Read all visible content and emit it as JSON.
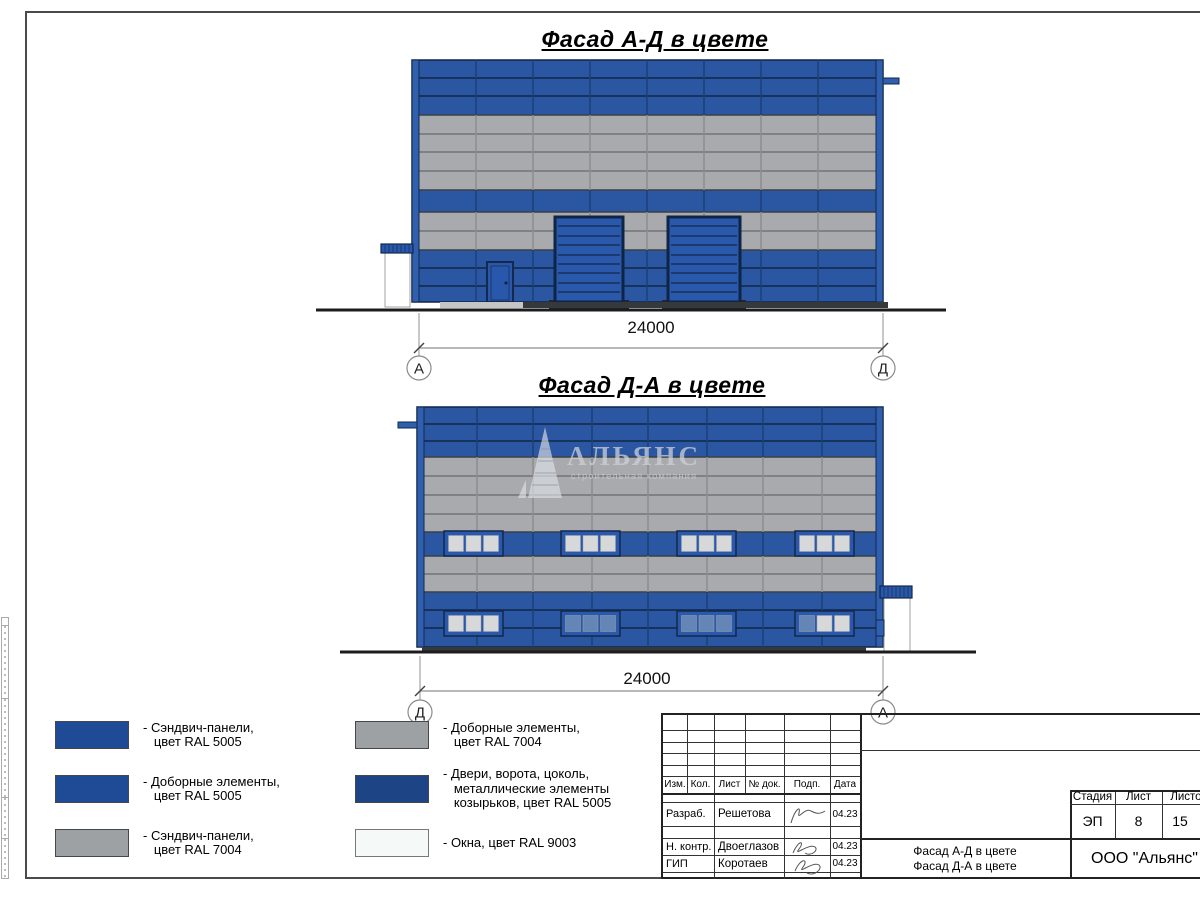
{
  "sheet": {
    "width": 1200,
    "height": 900
  },
  "colors": {
    "ral5005_swatch": "#1f4b96",
    "ral5005_panel": "#2b57a2",
    "ral7004_swatch": "#9ea1a4",
    "ral7004_panel": "#a8aaad",
    "doors_ral5005_swatch": "#1d4586",
    "windows_ral9003_swatch": "#f5f9f7",
    "frame_line": "#4a4a4a",
    "ground_line": "#1c1c1c"
  },
  "facade1": {
    "title": "Фасад А-Д в цвете",
    "dimension": "24000",
    "axis_left": "А",
    "axis_right": "Д"
  },
  "facade2": {
    "title": "Фасад Д-А в цвете",
    "dimension": "24000",
    "axis_left": "Д",
    "axis_right": "А"
  },
  "watermark": {
    "name": "АЛЬЯНС",
    "subtitle": "строительная компания"
  },
  "legend": {
    "items": [
      {
        "color": "#1f4b96",
        "label": "- Сэндвич-панели,\n   цвет RAL 5005"
      },
      {
        "color": "#1f4b96",
        "label": "- Доборные элементы,\n   цвет RAL 5005"
      },
      {
        "color": "#9ea1a4",
        "label": "- Сэндвич-панели,\n   цвет RAL 7004"
      },
      {
        "color": "#9ea1a4",
        "label": "- Доборные элементы,\n   цвет RAL 7004"
      },
      {
        "color": "#1d4586",
        "label": "- Двери, ворота, цоколь,\n   металлические элементы\n   козырьков, цвет RAL 5005"
      },
      {
        "color": "#f5f9f7",
        "label": "- Окна, цвет RAL 9003"
      }
    ]
  },
  "titleblock": {
    "cols": [
      "Изм.",
      "Кол.",
      "Лист",
      "№ док.",
      "Подп.",
      "Дата"
    ],
    "rows": [
      {
        "role": "Разраб.",
        "name": "Решетова",
        "date": "04.23"
      },
      {
        "role": "Н. контр.",
        "name": "Двоеглазов",
        "date": "04.23"
      },
      {
        "role": "ГИП",
        "name": "Коротаев",
        "date": "04.23"
      }
    ],
    "doc_name": "Фасад А-Д в цвете\nФасад Д-А в цвете",
    "org": "ООО \"Альянс\"",
    "stage_label": "Стадия",
    "sheet_label": "Лист",
    "sheets_label": "Листов",
    "stage": "ЭП",
    "sheet": "8",
    "sheets": "15"
  }
}
